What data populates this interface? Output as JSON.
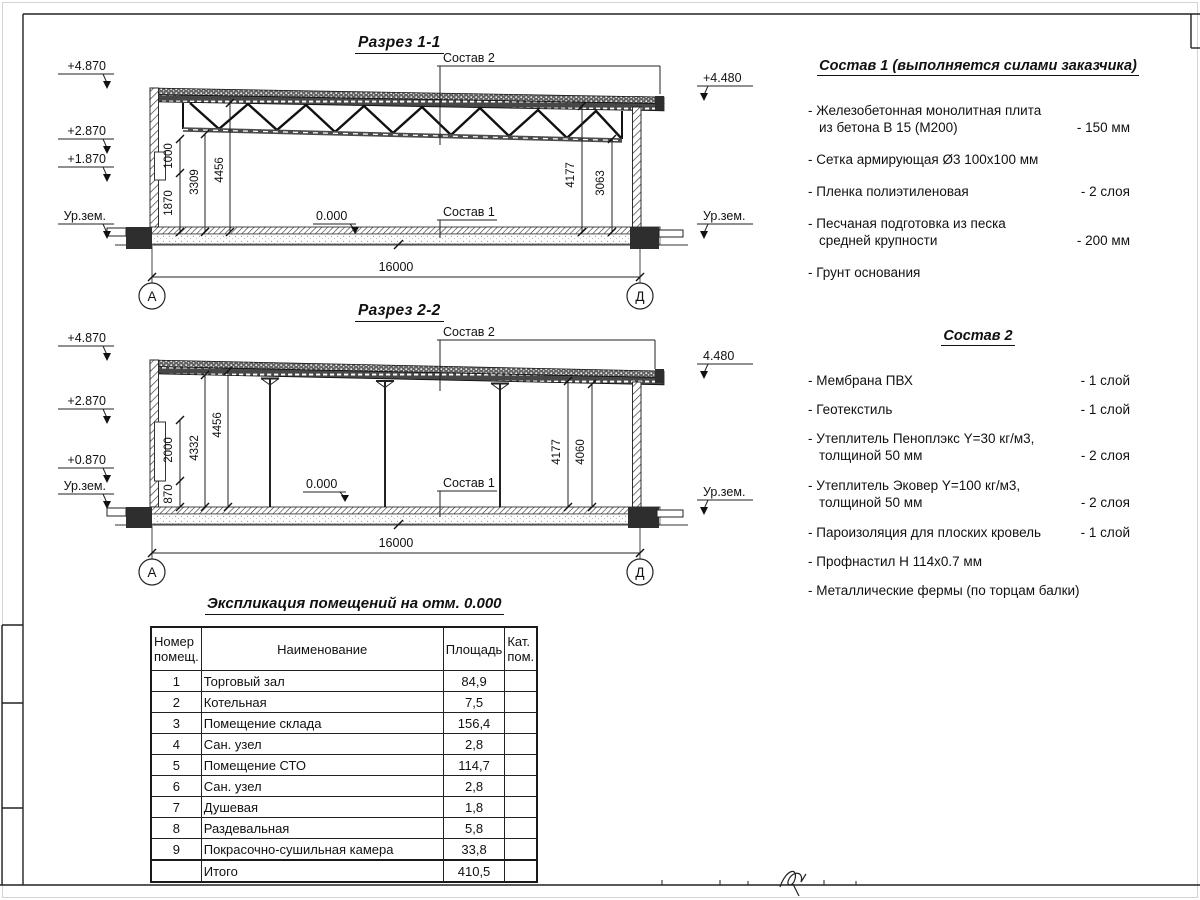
{
  "titles": {
    "section1": "Разрез 1-1",
    "section2": "Разрез 2-2",
    "explication": "Экспликация помещений на отм. 0.000"
  },
  "section1": {
    "levels": {
      "l1": "+4.870",
      "l2": "+2.870",
      "l3": "+1.870",
      "ground_left": "Ур.зем.",
      "right_top": "+4.480",
      "ground_right": "Ур.зем."
    },
    "dims": {
      "a": "1000",
      "b": "1870",
      "c": "3309",
      "d": "4456",
      "e": "4177",
      "f": "3063",
      "span": "16000",
      "zero": "0.000"
    },
    "leaders": {
      "sostav1": "Состав 1",
      "sostav2": "Состав 2"
    },
    "axes": {
      "left": "А",
      "right": "Д"
    }
  },
  "section2": {
    "levels": {
      "l1": "+4.870",
      "l2": "+2.870",
      "l3": "+0.870",
      "ground_left": "Ур.зем.",
      "right_top": "4.480",
      "ground_right": "Ур.зем."
    },
    "dims": {
      "a": "2000",
      "b": "870",
      "c": "4332",
      "d": "4456",
      "e": "4177",
      "f": "4060",
      "span": "16000",
      "zero": "0.000"
    },
    "leaders": {
      "sostav1": "Состав 1",
      "sostav2": "Состав 2"
    },
    "axes": {
      "left": "А",
      "right": "Д"
    }
  },
  "sostav1": {
    "title": "Состав 1 (выполняется силами заказчика)",
    "items": [
      {
        "line1": "- Железобетонная  монолитная плита",
        "line2": "из бетона В 15 (М200)",
        "value": "- 150 мм"
      },
      {
        "line1": "- Сетка армирующая Ø3 100х100 мм",
        "line2": "",
        "value": ""
      },
      {
        "line1": "- Пленка полиэтиленовая",
        "line2": "",
        "value": "-  2 слоя"
      },
      {
        "line1": "- Песчаная подготовка из песка",
        "line2": "средней крупности",
        "value": "- 200 мм"
      },
      {
        "line1": "- Грунт основания",
        "line2": "",
        "value": ""
      }
    ]
  },
  "sostav2": {
    "title": "Состав 2",
    "items": [
      {
        "line1": "- Мембрана ПВХ",
        "line2": "",
        "value": "- 1 слой"
      },
      {
        "line1": "- Геотекстиль",
        "line2": "",
        "value": "- 1 слой"
      },
      {
        "line1": "- Утеплитель Пеноплэкс Y=30 кг/м3,",
        "line2": "толщиной 50 мм",
        "value": "- 2 слоя"
      },
      {
        "line1": "- Утеплитель Эковер Y=100 кг/м3,",
        "line2": "толщиной 50 мм",
        "value": "- 2 слоя"
      },
      {
        "line1": "- Пароизоляция для плоских кровель",
        "line2": "",
        "value": "- 1 слой"
      },
      {
        "line1": "- Профнастил Н 114х0.7 мм",
        "line2": "",
        "value": ""
      },
      {
        "line1": "- Металлические фермы (по торцам балки)",
        "line2": "",
        "value": ""
      }
    ]
  },
  "explication": {
    "headers": {
      "num": "Номер помещ.",
      "name": "Наименование",
      "area": "Площадь",
      "cat": "Кат. пом."
    },
    "rows": [
      {
        "num": "1",
        "name": "Торговый зал",
        "area": "84,9",
        "cat": ""
      },
      {
        "num": "2",
        "name": "Котельная",
        "area": "7,5",
        "cat": ""
      },
      {
        "num": "3",
        "name": "Помещение склада",
        "area": "156,4",
        "cat": ""
      },
      {
        "num": "4",
        "name": "Сан. узел",
        "area": "2,8",
        "cat": ""
      },
      {
        "num": "5",
        "name": "Помещение СТО",
        "area": "114,7",
        "cat": ""
      },
      {
        "num": "6",
        "name": "Сан. узел",
        "area": "2,8",
        "cat": ""
      },
      {
        "num": "7",
        "name": "Душевая",
        "area": "1,8",
        "cat": ""
      },
      {
        "num": "8",
        "name": "Раздевальная",
        "area": "5,8",
        "cat": ""
      },
      {
        "num": "9",
        "name": "Покрасочно-сушильная камера",
        "area": "33,8",
        "cat": ""
      },
      {
        "num": "",
        "name": "Итого",
        "area": "410,5",
        "cat": ""
      }
    ]
  }
}
